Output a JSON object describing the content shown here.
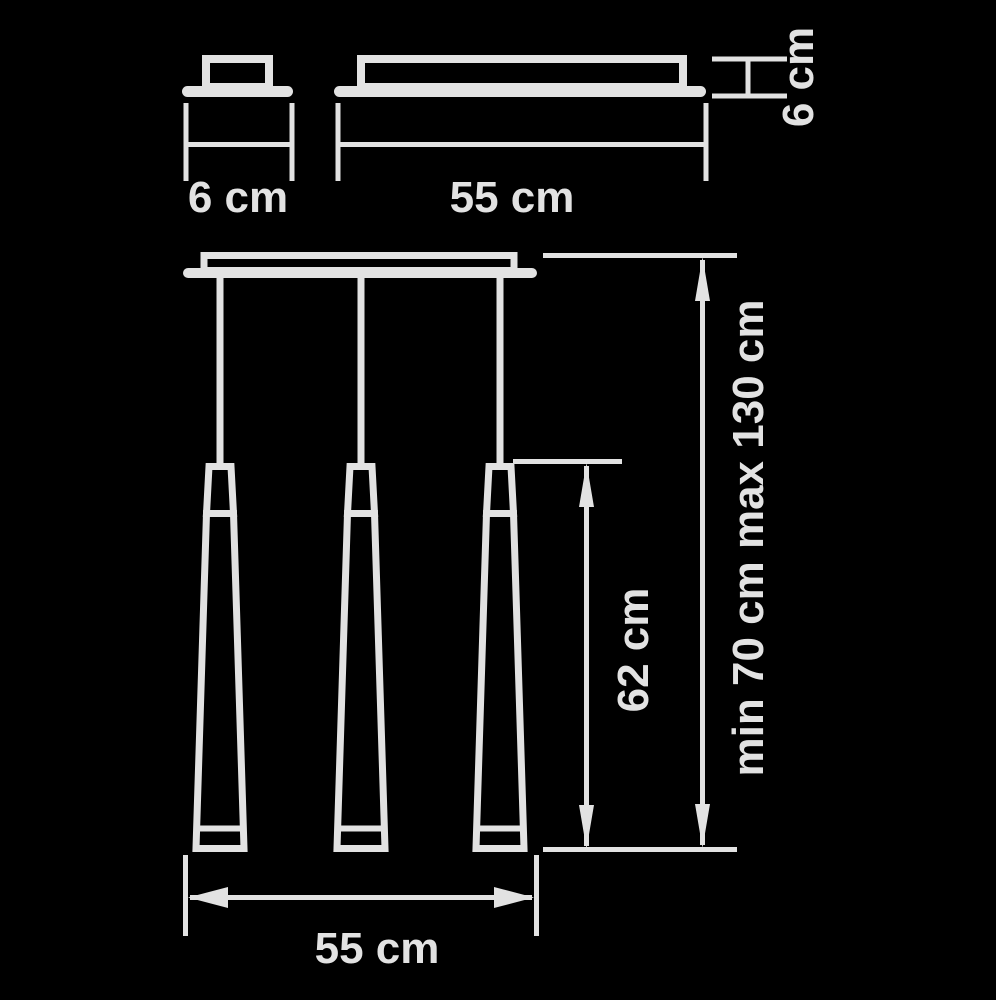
{
  "diagram": {
    "background": "#000000",
    "line_color": "#e2e2e2",
    "canopy_view": {
      "width_label": "6 cm"
    },
    "bar_view": {
      "length_label": "55 cm",
      "height_label": "6 cm"
    },
    "front_view": {
      "pendant_count": 3,
      "cone_height_label": "62 cm",
      "suspension_height_label": "min 70 cm max 130 cm",
      "bar_length_label": "55 cm"
    }
  }
}
